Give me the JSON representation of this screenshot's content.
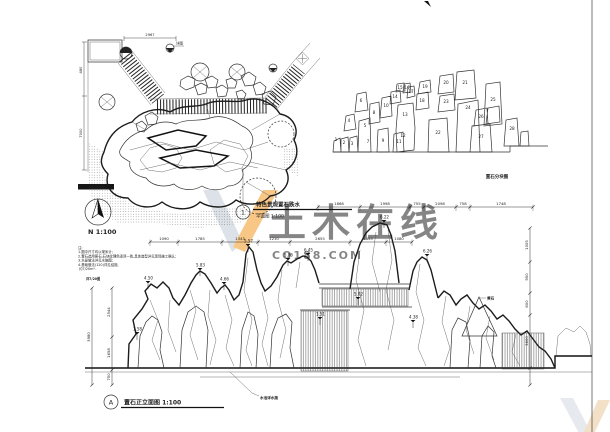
{
  "watermark": {
    "brand": "土木在线",
    "domain": "CO188.COM",
    "accent_color": "#f59a23",
    "grey_color": "#c3cbd6"
  },
  "plan": {
    "callout_no": "1",
    "title": "特色景观置石跌水",
    "scale_label": "平面图 1:100",
    "north_label": "N 1:100",
    "ref_label": "详见1/XX图",
    "detail_label": "详图",
    "dims": {
      "top": "2967",
      "left_a": "480",
      "left_b": "7000"
    }
  },
  "block_diagram": {
    "label": "置石分块图",
    "numbers": [
      {
        "n": "1",
        "x": 336,
        "y": 141
      },
      {
        "n": "2",
        "x": 344,
        "y": 144
      },
      {
        "n": "3",
        "x": 352,
        "y": 145
      },
      {
        "n": "4",
        "x": 349,
        "y": 122
      },
      {
        "n": "5",
        "x": 365,
        "y": 127
      },
      {
        "n": "6",
        "x": 361,
        "y": 102
      },
      {
        "n": "7",
        "x": 368,
        "y": 143
      },
      {
        "n": "8",
        "x": 374,
        "y": 114
      },
      {
        "n": "9",
        "x": 383,
        "y": 142
      },
      {
        "n": "10",
        "x": 386,
        "y": 107
      },
      {
        "n": "11",
        "x": 399,
        "y": 143
      },
      {
        "n": "12",
        "x": 403,
        "y": 137
      },
      {
        "n": "13",
        "x": 405,
        "y": 116
      },
      {
        "n": "14",
        "x": 395,
        "y": 98
      },
      {
        "n": "15",
        "x": 400,
        "y": 89
      },
      {
        "n": "16",
        "x": 407,
        "y": 89
      },
      {
        "n": "17",
        "x": 411,
        "y": 93
      },
      {
        "n": "18",
        "x": 422,
        "y": 102
      },
      {
        "n": "19",
        "x": 425,
        "y": 88
      },
      {
        "n": "20",
        "x": 446,
        "y": 84
      },
      {
        "n": "21",
        "x": 465,
        "y": 84
      },
      {
        "n": "22",
        "x": 438,
        "y": 134
      },
      {
        "n": "23",
        "x": 446,
        "y": 103
      },
      {
        "n": "24",
        "x": 468,
        "y": 109
      },
      {
        "n": "25",
        "x": 493,
        "y": 101
      },
      {
        "n": "26",
        "x": 481,
        "y": 118
      },
      {
        "n": "27",
        "x": 481,
        "y": 138
      },
      {
        "n": "28",
        "x": 512,
        "y": 130
      }
    ]
  },
  "elevation": {
    "callout_no": "A",
    "title": "置石正立面图 1:100",
    "top_note": "详7/20图",
    "notes": [
      "注:",
      "1.图中尺寸均以毫米计;",
      "2.置石选用黄石,石块纹理色泽须一致,具体造型详见现场施工确认;",
      "3.水景做法详见水施图;",
      "4.基础做法(120)详见结施,",
      "   约7/20m³."
    ],
    "flags": [
      {
        "x": 148,
        "y": 281,
        "v": "4.50"
      },
      {
        "x": 200,
        "y": 268,
        "v": "5.83"
      },
      {
        "x": 224,
        "y": 282,
        "v": "4.66"
      },
      {
        "x": 248,
        "y": 244,
        "v": "5.57"
      },
      {
        "x": 288,
        "y": 258,
        "v": "5.86"
      },
      {
        "x": 308,
        "y": 253,
        "v": "6.45"
      },
      {
        "x": 384,
        "y": 220,
        "v": "6.22"
      },
      {
        "x": 427,
        "y": 254,
        "v": "6.26"
      },
      {
        "x": 358,
        "y": 297,
        "v": "5.02"
      },
      {
        "x": 413,
        "y": 320,
        "v": "4.38"
      },
      {
        "x": 137,
        "y": 332,
        "v": "1.58"
      },
      {
        "x": 320,
        "y": 317,
        "v": "1.51"
      }
    ],
    "chains": [
      {
        "y": 242,
        "ticks": [
          150,
          178,
          222,
          258,
          290,
          350,
          386,
          412
        ],
        "labels": [
          {
            "x": 164,
            "t": "1090"
          },
          {
            "x": 200,
            "t": "1785"
          },
          {
            "x": 240,
            "t": "1343"
          },
          {
            "x": 274,
            "t": "1210"
          },
          {
            "x": 320,
            "t": "2655"
          },
          {
            "x": 368,
            "t": "1455"
          },
          {
            "x": 399,
            "t": "1080"
          }
        ]
      },
      {
        "y": 207,
        "ticks": [
          318,
          360,
          410,
          424,
          456,
          470,
          533
        ],
        "labels": [
          {
            "x": 339,
            "t": "1868"
          },
          {
            "x": 385,
            "t": "1998"
          },
          {
            "x": 417,
            "t": "755"
          },
          {
            "x": 440,
            "t": "2098"
          },
          {
            "x": 463,
            "t": "758"
          },
          {
            "x": 501,
            "t": "1748"
          }
        ]
      }
    ],
    "vchains": [
      {
        "x": 112,
        "ticks": [
          288,
          337,
          370,
          385
        ],
        "labels": [
          {
            "y": 312,
            "t": "2544"
          },
          {
            "y": 353,
            "t": "1658"
          },
          {
            "y": 377,
            "t": "750"
          }
        ]
      },
      {
        "x": 92,
        "ticks": [
          288,
          385
        ],
        "labels": [
          {
            "y": 337,
            "t": "3980"
          }
        ]
      },
      {
        "x": 530,
        "ticks": [
          228,
          262,
          293,
          315,
          368,
          385
        ],
        "labels": [
          {
            "y": 245,
            "t": "1005"
          },
          {
            "y": 277,
            "t": "950"
          },
          {
            "y": 304,
            "t": "600"
          },
          {
            "y": 341,
            "t": "3600"
          }
        ]
      }
    ],
    "labels": {
      "pool": "水池详水施",
      "stone": "黄石"
    }
  }
}
